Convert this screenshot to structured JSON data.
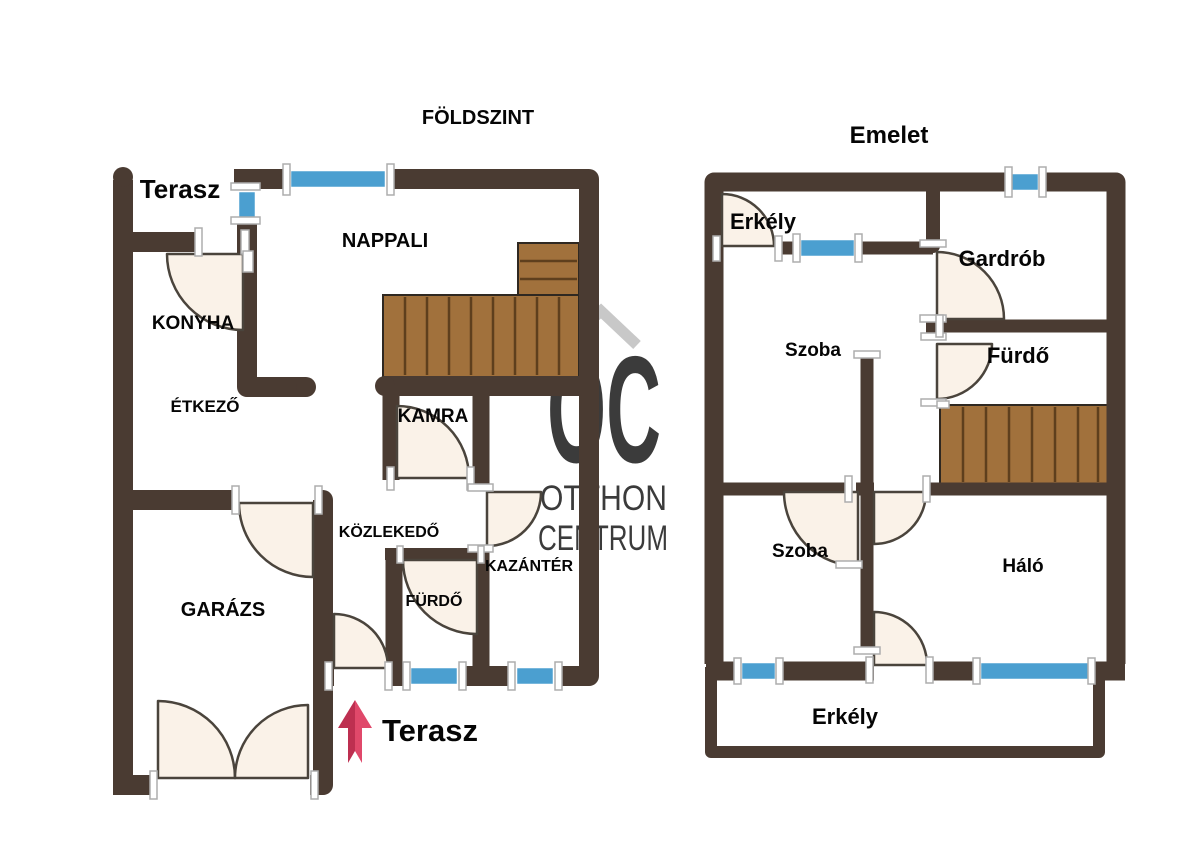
{
  "page": {
    "type": "real-estate floor plan"
  },
  "floors": {
    "ground": {
      "title": "FÖLDSZINT",
      "rooms": {
        "terasz_top": "Terasz",
        "nappali": "NAPPALI",
        "konyha": "KONYHA",
        "etkezo": "ÉTKEZŐ",
        "kamra": "KAMRA",
        "kozlekedo": "KÖZLEKEDŐ",
        "kazanter": "KAZÁNTÉR",
        "furdo": "FÜRDŐ",
        "garazs": "GARÁZS",
        "terasz_bottom": "Terasz"
      }
    },
    "upper": {
      "title": "Emelet",
      "rooms": {
        "erkely_top": "Erkély",
        "szoba_top": "Szoba",
        "gardrob": "Gardrób",
        "furdo": "Fürdő",
        "szoba_bottom": "Szoba",
        "halo": "Háló",
        "erkely_bottom": "Erkély"
      }
    }
  },
  "watermark": {
    "logo": "OC",
    "line1": "OTTHON",
    "line2": "CENTRUM"
  },
  "colors": {
    "wall": "#4a3b32",
    "window_glass": "#4b9fd0",
    "door_leaf": "#faf2e8",
    "door_outline": "#4a443c",
    "stair_wood": "#a1713c",
    "stair_line": "#5e3f1d",
    "watermark_gray": "#b9b9b9",
    "arrow_dark": "#bd2f50",
    "arrow_light": "#e0486a",
    "frame_cap": "#ffffff",
    "label": "#050505"
  }
}
